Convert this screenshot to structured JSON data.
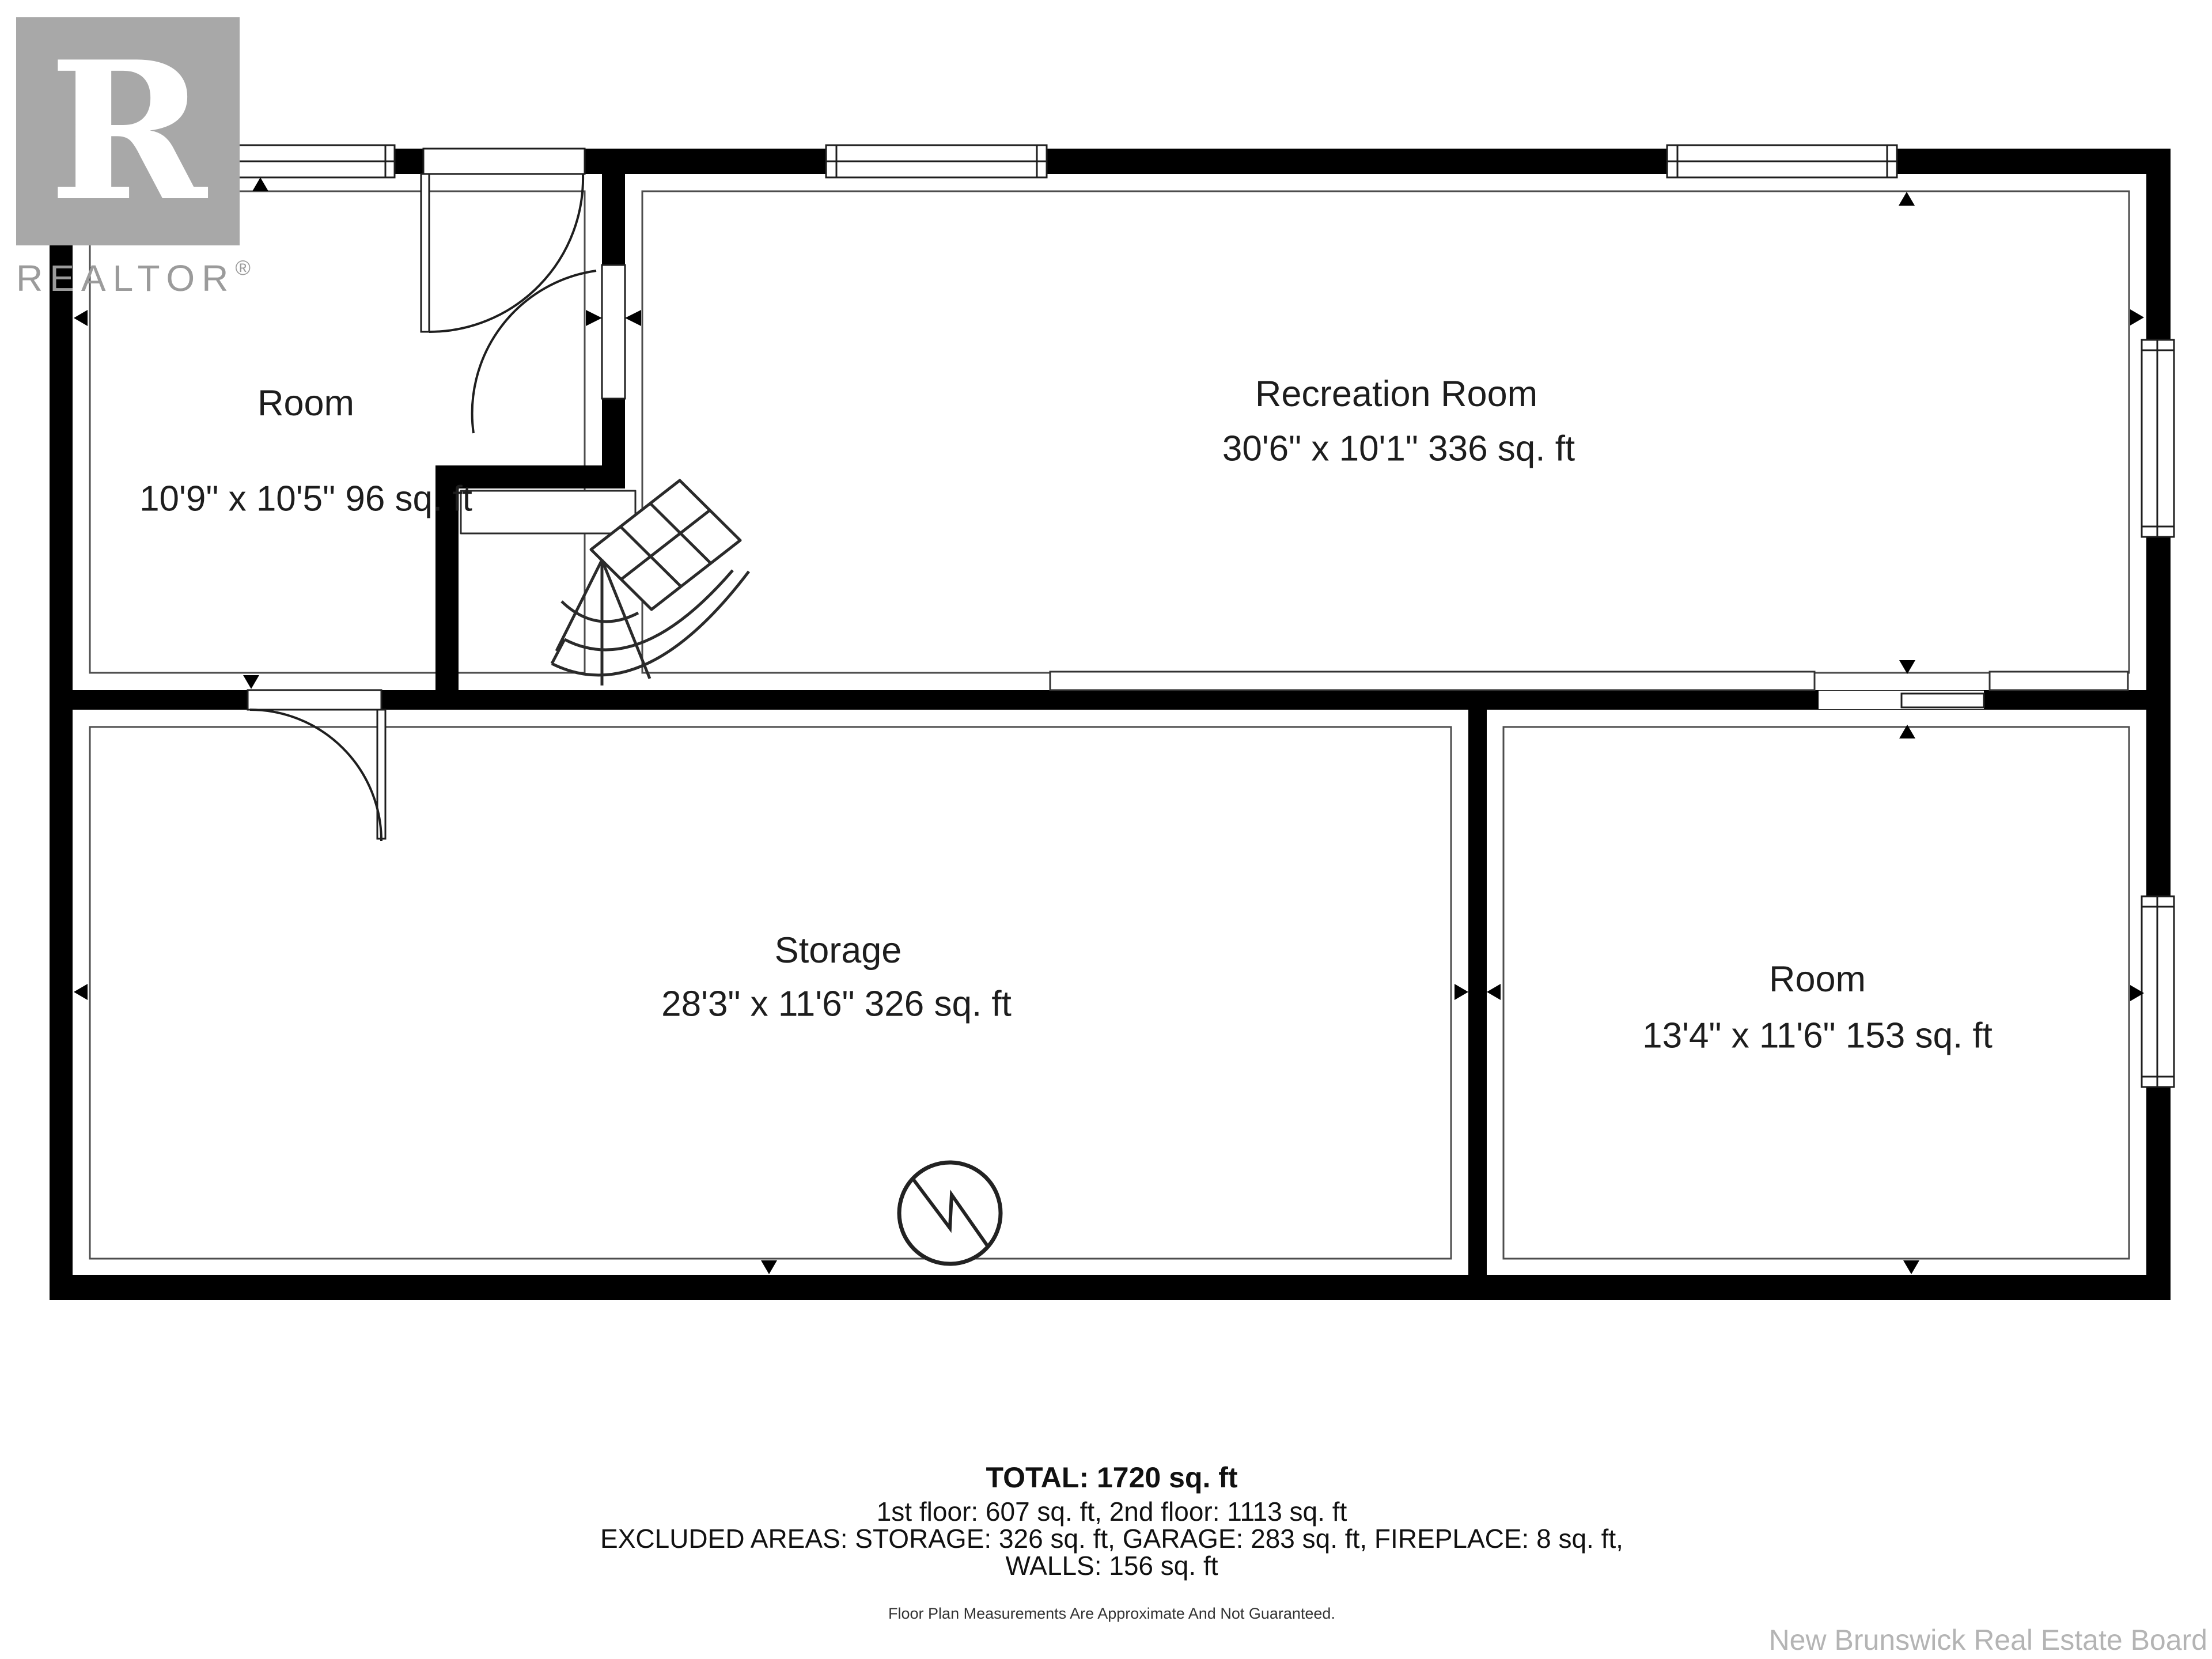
{
  "branding": {
    "logo_letter": "R",
    "logo_word": "REALTOR",
    "registered_mark": "®"
  },
  "rooms": [
    {
      "name": "Room",
      "dims": "10'9\" x 10'5\" 96 sq. ft"
    },
    {
      "name": "Recreation Room",
      "dims": "30'6\" x 10'1\" 336 sq. ft"
    },
    {
      "name": "Storage",
      "dims": "28'3\" x 11'6\" 326 sq. ft"
    },
    {
      "name": "Room",
      "dims": "13'4\" x 11'6\" 153 sq. ft"
    }
  ],
  "summary": {
    "total": "TOTAL: 1720 sq. ft",
    "floors": "1st floor: 607 sq. ft, 2nd floor: 1113 sq. ft",
    "excluded": "EXCLUDED AREAS: STORAGE: 326 sq. ft, GARAGE: 283 sq. ft, FIREPLACE: 8 sq. ft,",
    "walls": "WALLS: 156 sq. ft",
    "disclaimer": "Floor Plan Measurements Are Approximate And Not Guaranteed."
  },
  "watermark": "New Brunswick Real Estate Board",
  "colors": {
    "wall": "#000000",
    "line": "#2a2a2a",
    "inner_outline": "#4d4d4d",
    "logo_gray": "#a8a8a8",
    "logo_text_gray": "#9b9b9b",
    "watermark_gray": "#b4b4b4",
    "background": "#ffffff"
  }
}
